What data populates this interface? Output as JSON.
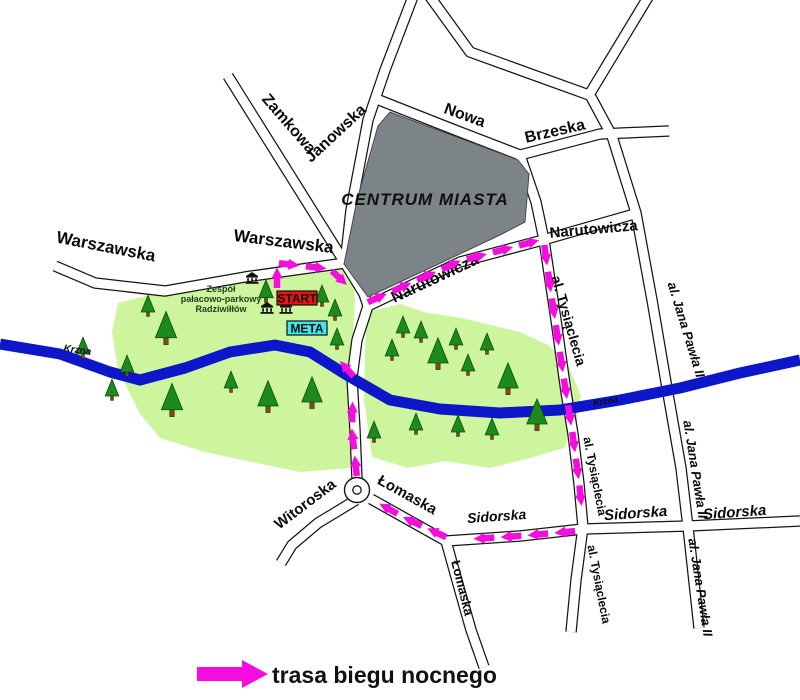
{
  "map": {
    "centrum_label": "CENTRUM MIASTA",
    "park_label_lines": [
      "Zespół",
      "pałacowo-parkowy",
      "Radziwiłłów"
    ],
    "markers": {
      "start": "START",
      "meta": "META"
    },
    "labels": [
      {
        "id": "warszawska_w",
        "text": "Warszawska"
      },
      {
        "id": "warszawska_e",
        "text": "Warszawska"
      },
      {
        "id": "zamkowa",
        "text": "Zamkowa"
      },
      {
        "id": "janowska",
        "text": "Janowska"
      },
      {
        "id": "nowa",
        "text": "Nowa"
      },
      {
        "id": "brzeska",
        "text": "Brzeska"
      },
      {
        "id": "narutowicza_diag",
        "text": "Narutowicza"
      },
      {
        "id": "narutowicza_e",
        "text": "Narutowicza"
      },
      {
        "id": "tysiaclecia_n",
        "text": "al. Tysiąclecia"
      },
      {
        "id": "tysiaclecia_mid",
        "text": "al. Tysiąclecia"
      },
      {
        "id": "tysiaclecia_s",
        "text": "al. Tysiąclecia"
      },
      {
        "id": "janapawla_n",
        "text": "al. Jana Pawła II"
      },
      {
        "id": "janapawla_mid",
        "text": "al. Jana Pawła II"
      },
      {
        "id": "janapawla_s",
        "text": "al. Jana Pawła II"
      },
      {
        "id": "sidorska_w",
        "text": "Sidorska"
      },
      {
        "id": "sidorska_mid",
        "text": "Sidorska"
      },
      {
        "id": "sidorska_e",
        "text": "Sidorska"
      },
      {
        "id": "lomaska_ne",
        "text": "Łomaska"
      },
      {
        "id": "lomaska_s",
        "text": "Łomaska"
      },
      {
        "id": "witoroska",
        "text": "Witoroska"
      },
      {
        "id": "krzna_w",
        "text": "Krzna"
      },
      {
        "id": "krzna_e",
        "text": "Krzna"
      }
    ],
    "route": {
      "legs": [
        [
          [
            277,
            290
          ],
          [
            277,
            263
          ],
          [
            330,
            269
          ],
          [
            366,
            303
          ]
        ],
        [
          [
            366,
            303
          ],
          [
            460,
            261
          ],
          [
            544,
            239
          ]
        ],
        [
          [
            544,
            243
          ],
          [
            552,
            300
          ],
          [
            564,
            380
          ],
          [
            572,
            430
          ],
          [
            579,
            482
          ],
          [
            583,
            519
          ]
        ],
        [
          [
            577,
            531
          ],
          [
            520,
            536
          ],
          [
            455,
            540
          ]
        ],
        [
          [
            448,
            538
          ],
          [
            405,
            518
          ],
          [
            373,
            500
          ]
        ],
        [
          [
            357,
            478
          ],
          [
            352,
            430
          ],
          [
            353,
            382
          ]
        ],
        [
          [
            355,
            378
          ],
          [
            322,
            341
          ]
        ]
      ]
    },
    "colors": {
      "route": "#F40DDC",
      "river": "#0D16C8",
      "park": "#CDF59E",
      "tree": "#1D8A1E",
      "trunk": "#7A4E18",
      "centrum": "#7D8488",
      "start_bg": "#E91515",
      "meta_bg": "#3FE6EE"
    }
  },
  "legend": {
    "label": "trasa biegu nocnego"
  }
}
